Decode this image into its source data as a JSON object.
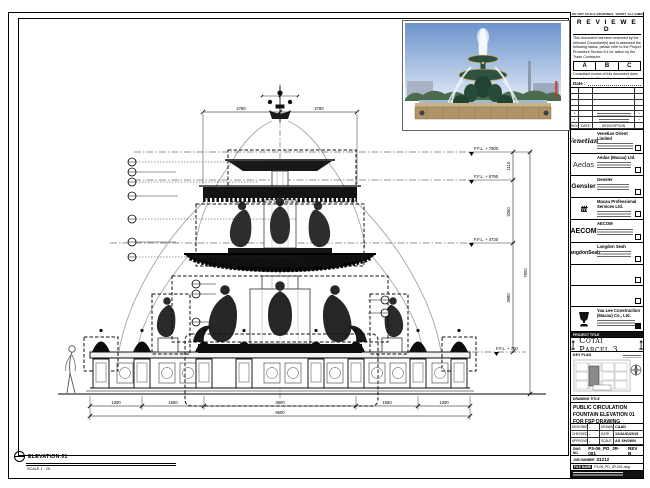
{
  "sheet": {
    "top_note": "DO NOT SCALE DRAWINGS. VERIFY ALL DIMENSIONS ON SITE."
  },
  "stamp": {
    "title": "R E V I E W E D",
    "body1": "This document has been reviewed by the relevant Consultant(s) and is assessed the following status, please refer to the Project Procedure Section 5.4 for action by the Trade Contractor.",
    "grades": [
      "A",
      "B",
      "C"
    ],
    "body2": "Consultant review of this document does not relieve the Trade Contractor of its responsibilities under the Trade Contract.",
    "date_label": "Date :"
  },
  "revisions": {
    "headers": [
      "REV",
      "DATE",
      "DESCRIPTION"
    ],
    "mark": "*"
  },
  "consultants": [
    {
      "logo": "Venetian",
      "name": "Venetian Orient Limited"
    },
    {
      "logo": "Aedas",
      "name": "Aedas (Macau) Ltd."
    },
    {
      "logo": "Gensler",
      "name": "Gensler"
    },
    {
      "logo": "ttt",
      "name": "Macau Professional Services Ltd."
    },
    {
      "logo": "AECOM",
      "name": "AECOM"
    },
    {
      "logo": "LangdonSeah",
      "name": "Langdon Seah"
    }
  ],
  "contractor": {
    "name": "Yau Lee Construction (Macau) Co., Ltd."
  },
  "project": {
    "label": "PROJECT TITLE",
    "title": "Cotai Parcel 3"
  },
  "key_plan": {
    "label": "KEY PLAN"
  },
  "drawing_title": {
    "label": "DRAWING TITLE",
    "line1": "PUBLIC CIRCULATION",
    "line2": "FOUNTAIN ELEVATION 01",
    "line3": "FOR FSP DRAWING"
  },
  "info": {
    "designed_label": "DESIGNED",
    "designed": "-",
    "drawn_label": "DRAWN",
    "drawn": "CAAD",
    "checked_label": "CHECKED",
    "checked": "-",
    "date_label": "DATE",
    "date": "12/AUG/2015",
    "approved_label": "APPROVED",
    "approved": "-",
    "scale_label": "SCALE",
    "scale": "AS SHOWN"
  },
  "numbers": {
    "dwg_label": "DWG NO.",
    "dwg_no": "P3-06_PD_JR-001",
    "rev": "REV B",
    "job_label": "JOB NUMBER",
    "job_no": "31212",
    "file_label": "FILE NAME",
    "file_name": "P3-06_PD_JR-001.dwg"
  },
  "view": {
    "title": "ELEVATION 01",
    "scale": "SCALE 1 : 25"
  },
  "annotations": {
    "levels": [
      "F.F.L. + 7900",
      "F.F.L. + 6790",
      "F.F.L. + 4730",
      "F.F.L. + 750"
    ],
    "vdims": [
      "1110",
      "2060",
      "3980",
      "7900"
    ],
    "top_dims": [
      "2780",
      "2780"
    ],
    "bottom_dims": [
      "1300",
      "1550",
      "3800",
      "1550",
      "1300"
    ],
    "bottom_total": "9500"
  }
}
